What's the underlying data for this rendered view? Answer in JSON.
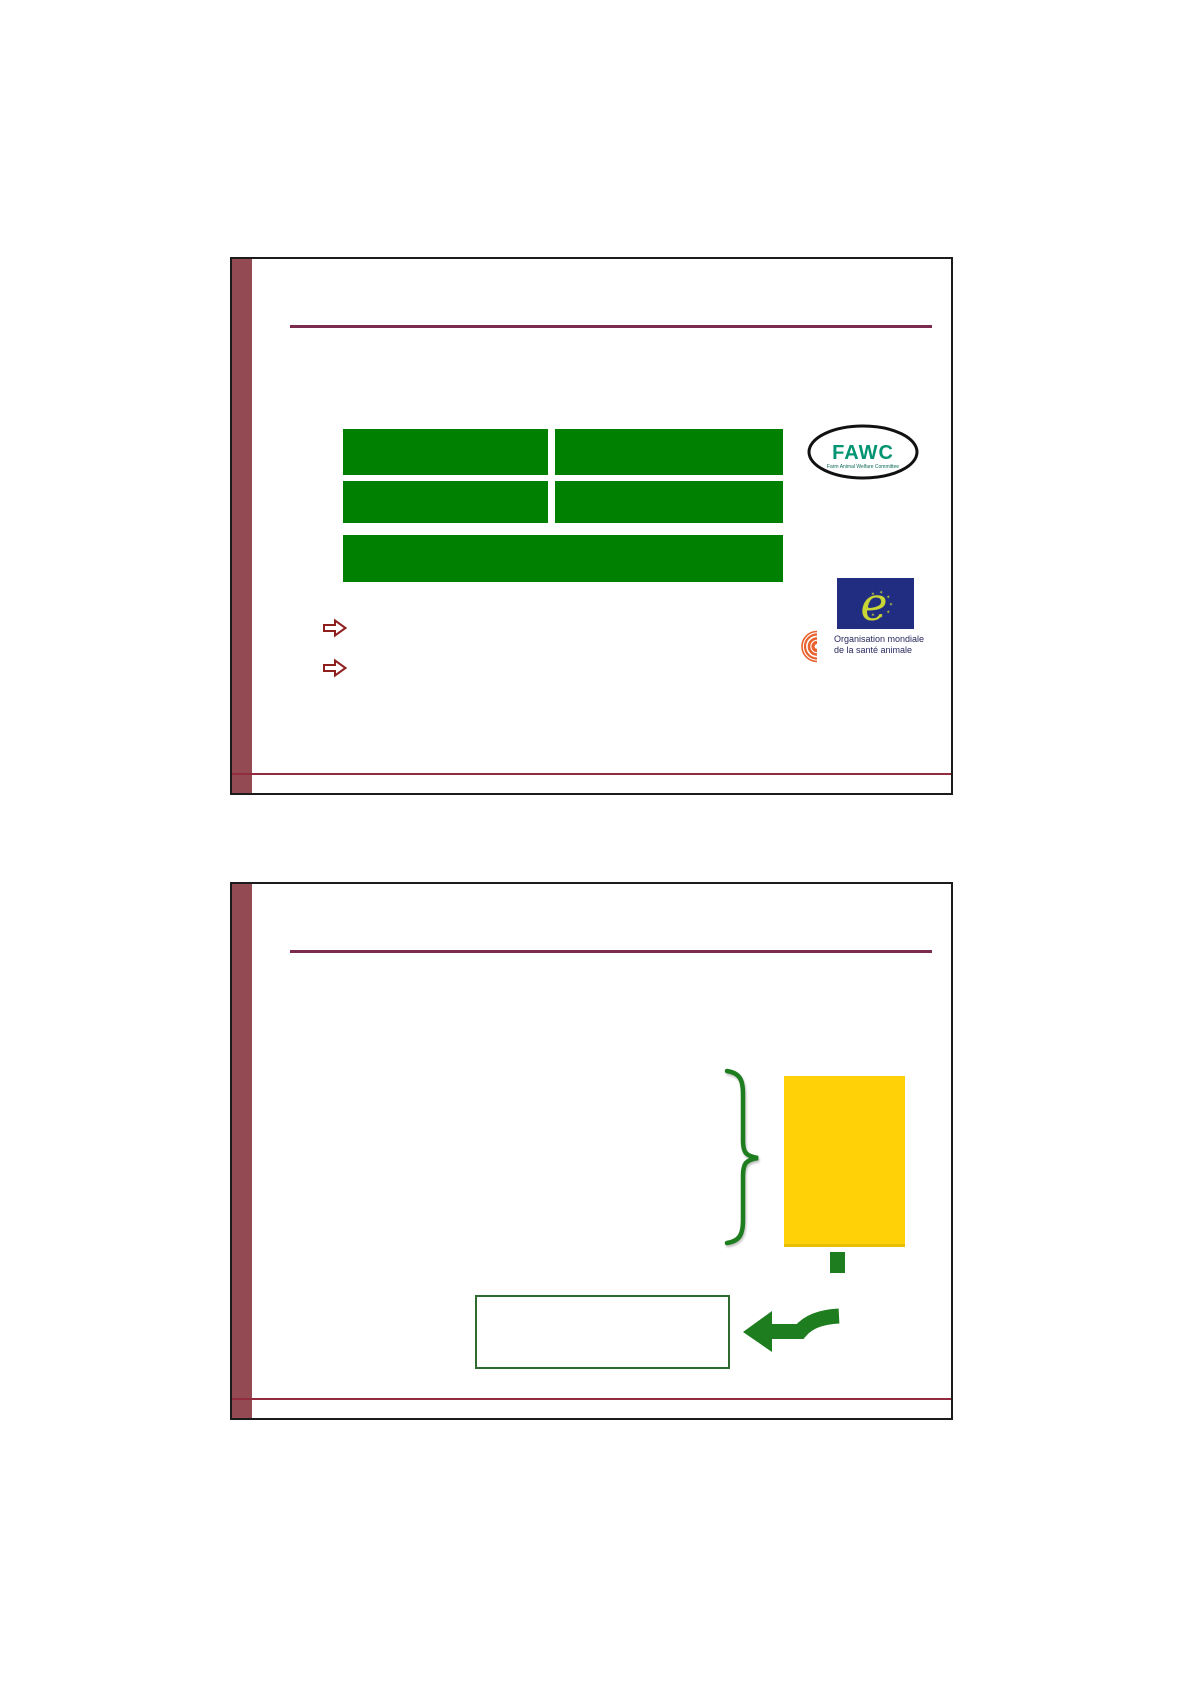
{
  "page": {
    "description": "Printed handout page showing two presentation slides with redacted text placeholders",
    "background": "#ffffff"
  },
  "colors": {
    "slide_border": "#1b1b1b",
    "sidebar_maroon": "#944A52",
    "title_underline_maroon": "#7B2B4D",
    "footer_line_maroon": "#922B3E",
    "placeholder_green": "#008000",
    "accent_green": "#1E7D1E",
    "outlined_box_green": "#2E6B2E",
    "highlight_yellow": "#FFD106",
    "bullet_arrow_red": "#8E1F1F",
    "fawc_green": "#009472",
    "coe_blue": "#202D80",
    "coe_yellow": "#C9D535",
    "oie_orange": "#E8622D",
    "oie_text_navy": "#29295E"
  },
  "slide1": {
    "name": "slide-1",
    "content_placeholder_bars": 5,
    "bullet_arrows": 2,
    "fawc_logo": {
      "title": "FAWC",
      "subtitle": "Farm Animal Welfare Committee"
    },
    "coe_logo": {
      "letter": "e"
    },
    "oie_logo": {
      "line1": "Organisation mondiale",
      "line2": "de la santé animale"
    }
  },
  "slide2": {
    "name": "slide-2",
    "shapes": [
      "curly-brace",
      "yellow-panel",
      "green-square",
      "outlined-box",
      "bent-arrow"
    ]
  }
}
